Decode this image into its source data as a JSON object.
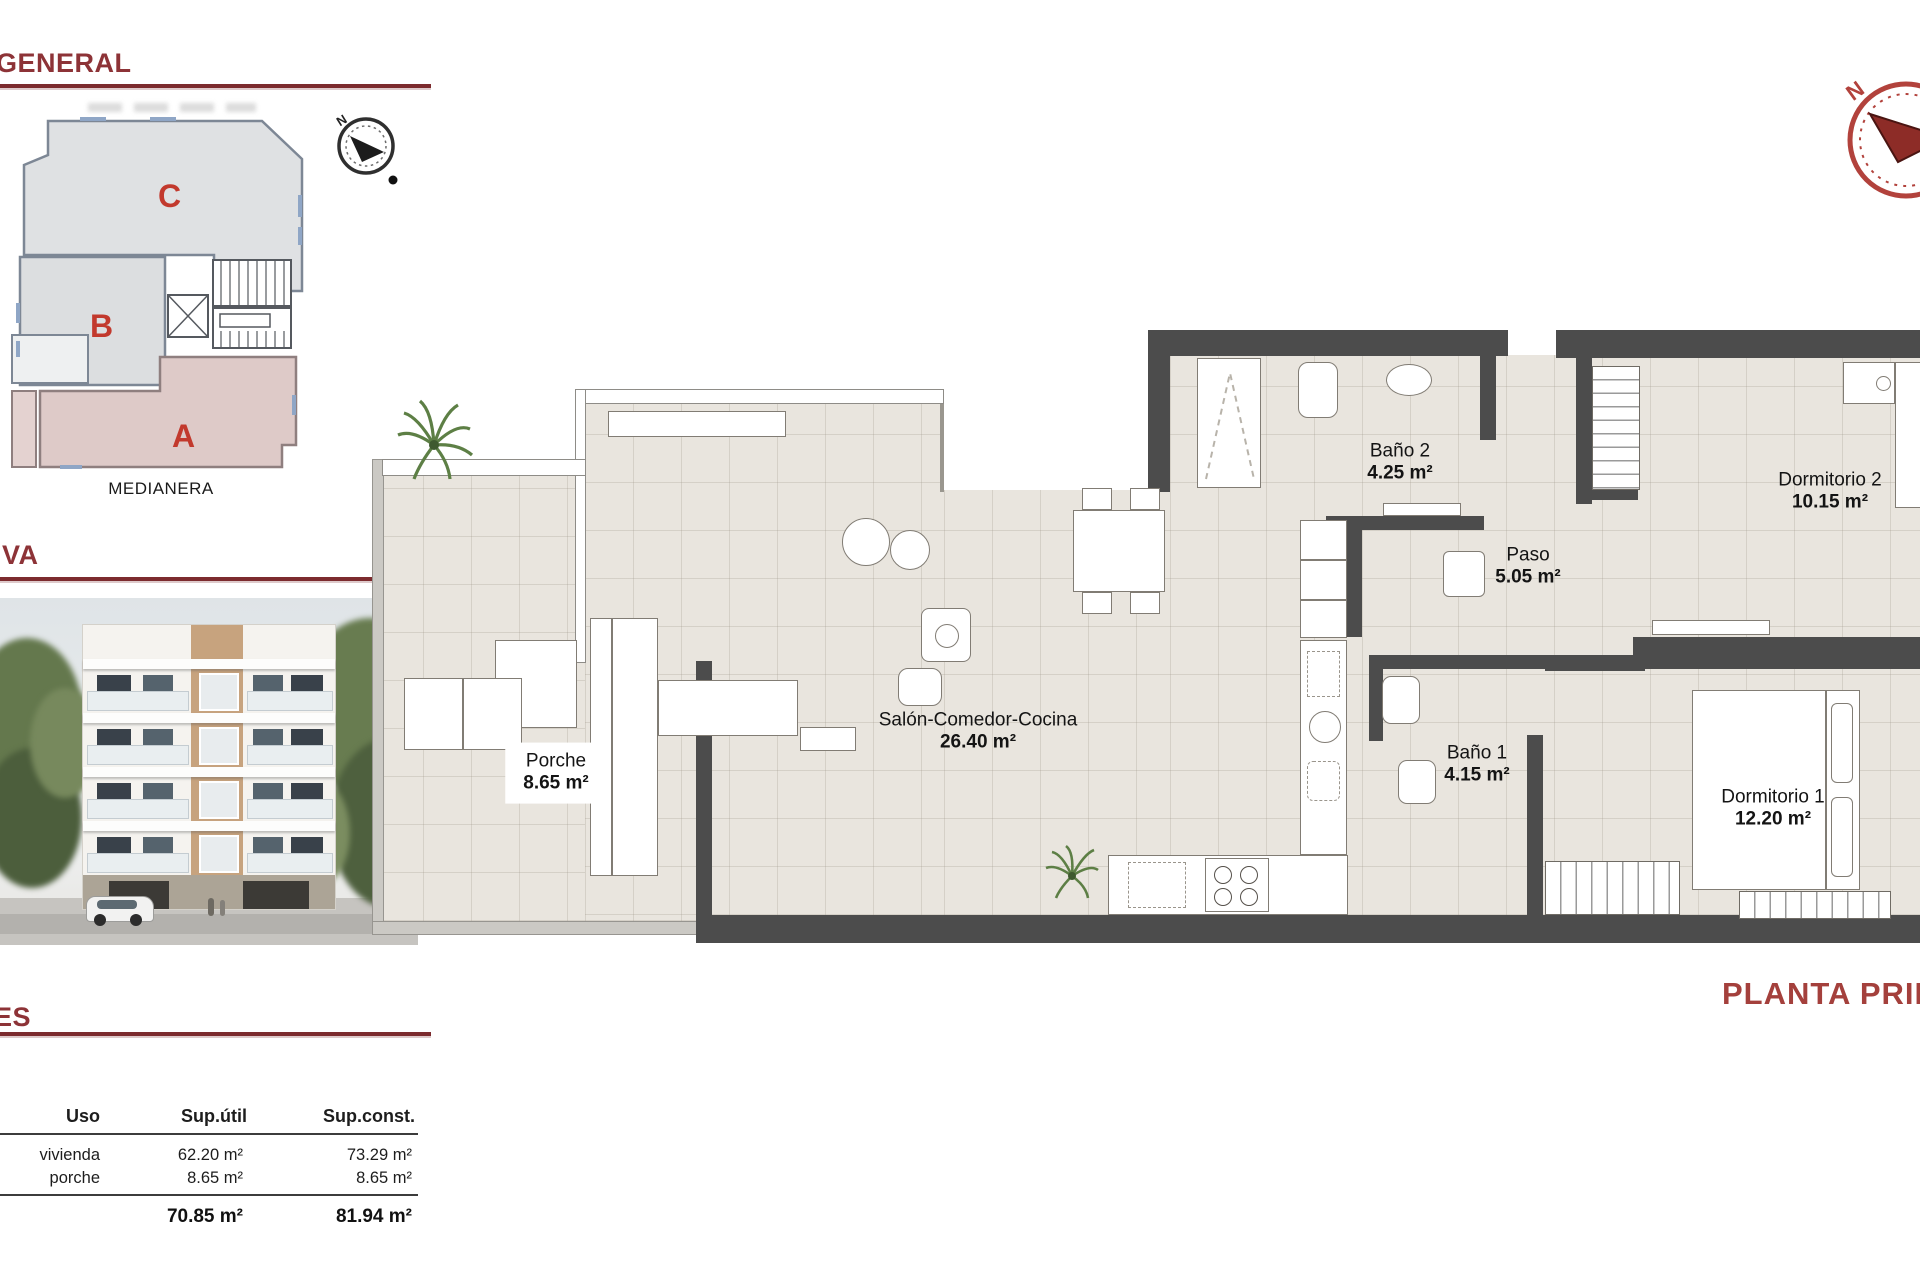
{
  "panels": {
    "general": {
      "title": "GENERAL",
      "medianera_label": "MEDIANERA",
      "blocks": [
        {
          "label": "C"
        },
        {
          "label": "B"
        },
        {
          "label": "A"
        }
      ],
      "compass_n": "N"
    },
    "perspective": {
      "title": "VA"
    },
    "areas": {
      "title": "ES",
      "table": {
        "headers": [
          "Uso",
          "Sup.útil",
          "Sup.const."
        ],
        "rows": [
          {
            "uso": "vivienda",
            "util": "62.20 m²",
            "const": "73.29 m²"
          },
          {
            "uso": "porche",
            "util": "8.65 m²",
            "const": "8.65 m²"
          }
        ],
        "totals": {
          "util": "70.85 m²",
          "const": "81.94 m²"
        }
      }
    }
  },
  "plan": {
    "title": "PLANTA PRIMERA",
    "compass_n": "N",
    "rooms": [
      {
        "name": "Baño 2",
        "area": "4.25 m²"
      },
      {
        "name": "Paso",
        "area": "5.05 m²"
      },
      {
        "name": "Dormitorio 2",
        "area": "10.15 m²"
      },
      {
        "name": "Salón-Comedor-Cocina",
        "area": "26.40 m²"
      },
      {
        "name": "Porche",
        "area": "8.65 m²"
      },
      {
        "name": "Baño 1",
        "area": "4.15 m²"
      },
      {
        "name": "Dormitorio 1",
        "area": "12.20 m²"
      }
    ]
  },
  "colors": {
    "header_red": "#8d3337",
    "title_red": "#a4403c",
    "wall": "#4c4c4c",
    "floor": "#e9e5de",
    "block_gray": "#dfe1e3",
    "block_pink": "#decac8",
    "block_letter_red": "#c2392d",
    "compass_red": "#b2423c"
  }
}
